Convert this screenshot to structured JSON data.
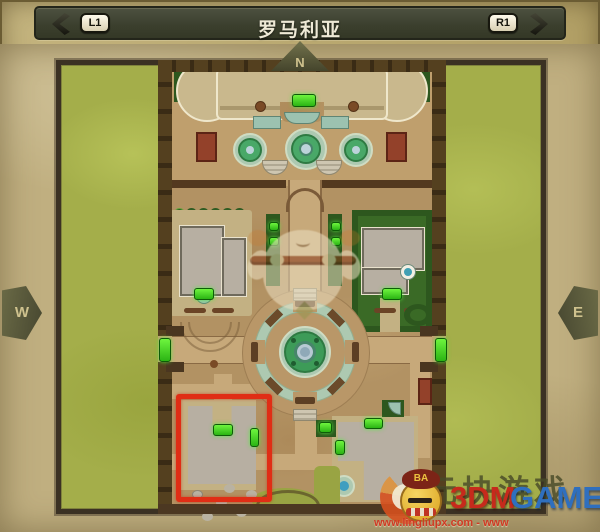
{
  "header": {
    "l1_label": "L1",
    "r1_label": "R1",
    "title": "罗马利亚"
  },
  "compass": {
    "north": "N",
    "west": "W",
    "east": "E"
  },
  "icons": {
    "back": "chevron-left-icon",
    "forward": "chevron-right-icon",
    "item": "teal-drop-icon"
  },
  "markers": {
    "door_color": "#3fd02c",
    "highlight_color": "#e02d15"
  },
  "watermarks": {
    "brand_cn": "元块游戏",
    "brand_red": "3DM",
    "brand_blue": "GAME",
    "beret_label": "BA",
    "url_line": "www.lingliupx.com - www"
  },
  "colors": {
    "frame": "#b2a066",
    "header_bar": "#3b3f2d",
    "parchment": "#c0af80",
    "grass": "#a4ae4a",
    "wall": "#54401f",
    "dirt": "#b29263",
    "building": "#b7afa2",
    "hedge": "#2d571e",
    "plaza_ring": "#adc9b1",
    "fountain_water": "#3d9b58",
    "door_green": "#3fd02c",
    "highlight_red": "#e02d15",
    "brand_red": "#c62a1c",
    "brand_blue": "#2f6fbe"
  }
}
